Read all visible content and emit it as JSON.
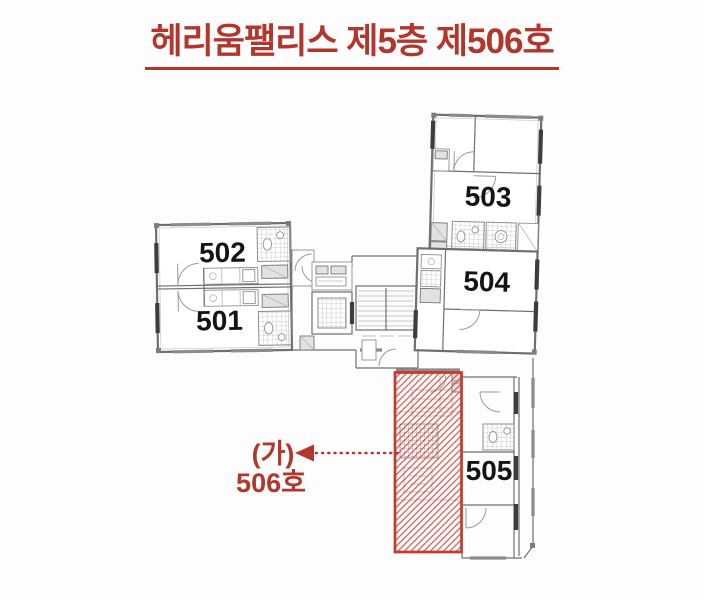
{
  "title": {
    "text": "헤리움팰리스 제5층 제506호"
  },
  "colors": {
    "accent_red": "#b2362c",
    "highlight_border": "#c43a2c",
    "highlight_hatch": "#cf4438",
    "plan_ink": "#6f6f6f",
    "window_ink": "#3d3d3d"
  },
  "plan": {
    "rooms": [
      {
        "label": "502"
      },
      {
        "label": "501"
      },
      {
        "label": "503"
      },
      {
        "label": "504"
      },
      {
        "label": "505"
      }
    ],
    "highlight": {
      "unit": "506",
      "annotation_line1": "(가)",
      "annotation_line2": "506호"
    }
  }
}
